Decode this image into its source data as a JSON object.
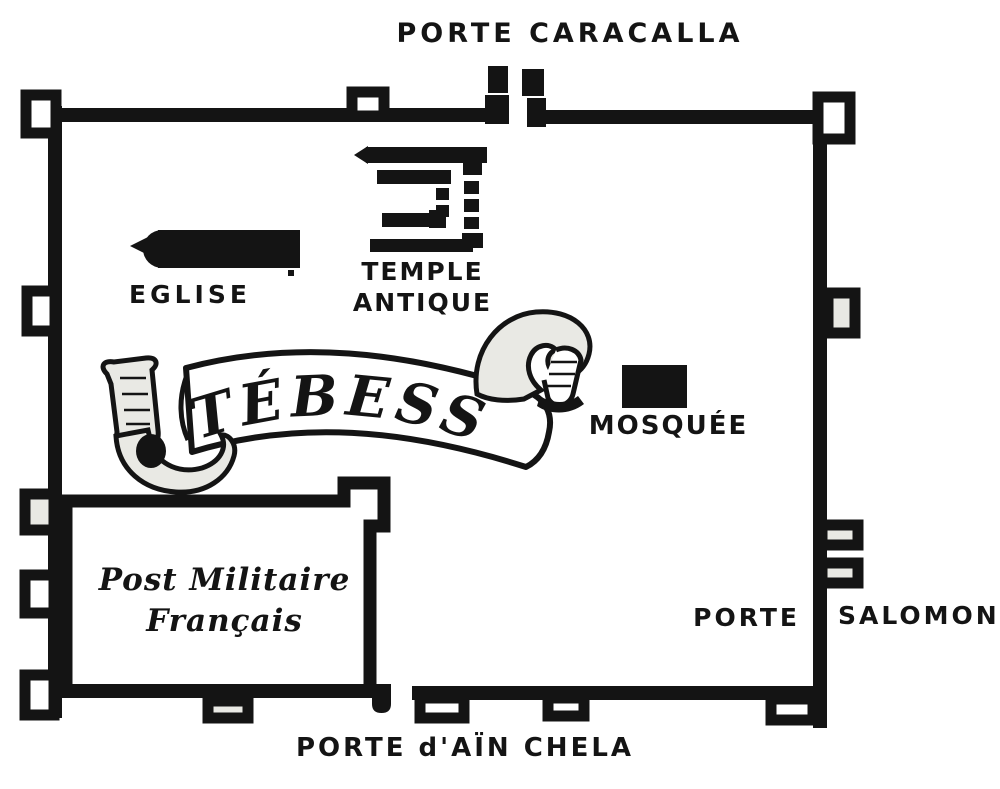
{
  "canvas": {
    "width": 1000,
    "height": 789,
    "background": "#ffffff",
    "ink": "#141414",
    "stipple_fill": "#e9e9e4"
  },
  "banner": {
    "title": "TÉBESSA"
  },
  "gates": {
    "north": {
      "label": "PORTE CARACALLA"
    },
    "east": {
      "label_left": "PORTE",
      "label_right": "SALOMON"
    },
    "south": {
      "label": "PORTE d'AÏN CHELA"
    }
  },
  "landmarks": {
    "temple": {
      "line1": "TEMPLE",
      "line2": "ANTIQUE"
    },
    "church": {
      "label": "EGLISE"
    },
    "mosque": {
      "label": "MOSQUÉE"
    },
    "military_post": {
      "line1": "Post Militaire",
      "line2": "Français"
    }
  }
}
